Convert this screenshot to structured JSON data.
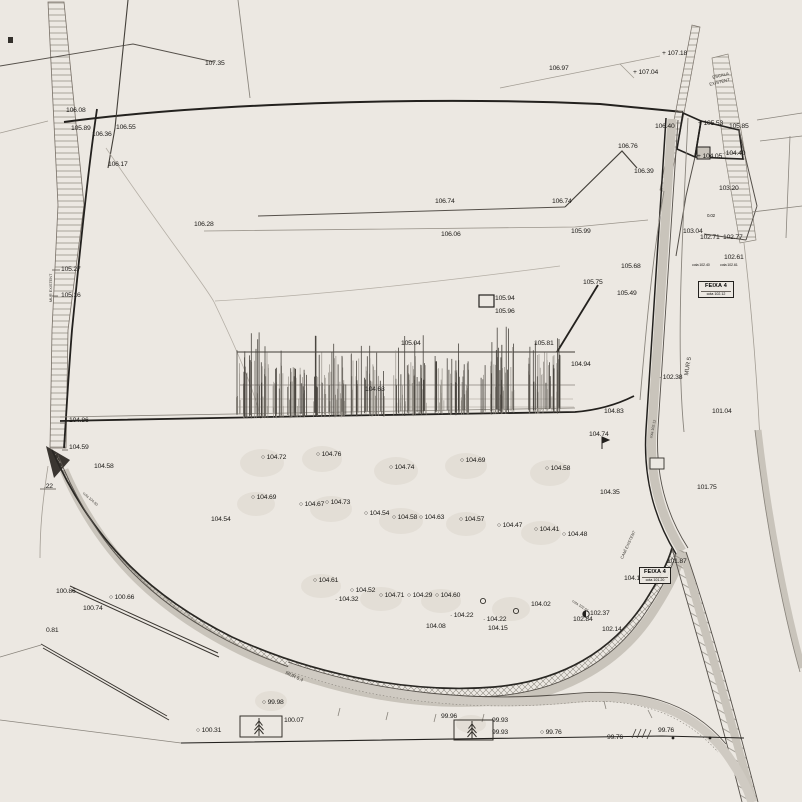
{
  "palette": {
    "background": "#ece8e2",
    "ink_dark": "#23211e",
    "ink_mid": "#55504a",
    "ink_faint": "#a39d94",
    "band_fill": "#c9c4bb",
    "hatch": "#8a857d",
    "label_text": "#1d1b18"
  },
  "plan": {
    "point_labels": [
      {
        "x": 205,
        "y": 61,
        "t": "107.35"
      },
      {
        "x": 549,
        "y": 66,
        "t": "106.97"
      },
      {
        "x": 633,
        "y": 70,
        "t": "107.04",
        "m": "+"
      },
      {
        "x": 662,
        "y": 51,
        "t": "107.18",
        "m": "+"
      },
      {
        "x": 66,
        "y": 108,
        "t": "106.08"
      },
      {
        "x": 698,
        "y": 121,
        "t": "105.53",
        "m": "+"
      },
      {
        "x": 729,
        "y": 124,
        "t": "105.85"
      },
      {
        "x": 71,
        "y": 126,
        "t": "105.89"
      },
      {
        "x": 92,
        "y": 132,
        "t": "106.36"
      },
      {
        "x": 116,
        "y": 125,
        "t": "106.55"
      },
      {
        "x": 655,
        "y": 124,
        "t": "106.40"
      },
      {
        "x": 108,
        "y": 162,
        "t": "106.17"
      },
      {
        "x": 618,
        "y": 144,
        "t": "106.76"
      },
      {
        "x": 697,
        "y": 154,
        "t": "104.05",
        "m": "+"
      },
      {
        "x": 722,
        "y": 151,
        "t": "104.40",
        "m": "d"
      },
      {
        "x": 634,
        "y": 169,
        "t": "106.39"
      },
      {
        "x": 719,
        "y": 186,
        "t": "103.20"
      },
      {
        "x": 435,
        "y": 199,
        "t": "106.74"
      },
      {
        "x": 552,
        "y": 199,
        "t": "106.74"
      },
      {
        "x": 194,
        "y": 222,
        "t": "106.28"
      },
      {
        "x": 441,
        "y": 232,
        "t": "106.06"
      },
      {
        "x": 571,
        "y": 229,
        "t": "105.99"
      },
      {
        "x": 707,
        "y": 214,
        "t": "0.02",
        "s": 4.5
      },
      {
        "x": 683,
        "y": 229,
        "t": "103.04"
      },
      {
        "x": 700,
        "y": 235,
        "t": "102.71"
      },
      {
        "x": 723,
        "y": 235,
        "t": "102.77"
      },
      {
        "x": 724,
        "y": 255,
        "t": "102.61"
      },
      {
        "x": 692,
        "y": 264,
        "t": "cota 102.40",
        "s": 3.8
      },
      {
        "x": 720,
        "y": 264,
        "t": "cota 102.61",
        "s": 3.8
      },
      {
        "x": 61,
        "y": 267,
        "t": "105.27"
      },
      {
        "x": 61,
        "y": 293,
        "t": "105.16"
      },
      {
        "x": 621,
        "y": 264,
        "t": "105.68"
      },
      {
        "x": 583,
        "y": 280,
        "t": "105.75"
      },
      {
        "x": 617,
        "y": 291,
        "t": "105.49"
      },
      {
        "x": 495,
        "y": 296,
        "t": "105.94"
      },
      {
        "x": 495,
        "y": 309,
        "t": "105.96"
      },
      {
        "x": 401,
        "y": 341,
        "t": "105.04"
      },
      {
        "x": 534,
        "y": 341,
        "t": "105.81"
      },
      {
        "x": 571,
        "y": 362,
        "t": "104.94"
      },
      {
        "x": 659,
        "y": 375,
        "t": "102.38",
        "m": "d"
      },
      {
        "x": 365,
        "y": 387,
        "t": "104.63"
      },
      {
        "x": 604,
        "y": 409,
        "t": "104.83"
      },
      {
        "x": 712,
        "y": 409,
        "t": "101.04"
      },
      {
        "x": 589,
        "y": 432,
        "t": "104.74"
      },
      {
        "x": 69,
        "y": 418,
        "t": "104.86"
      },
      {
        "x": 69,
        "y": 445,
        "t": "104.59"
      },
      {
        "x": 94,
        "y": 464,
        "t": "104.58"
      },
      {
        "x": 44,
        "y": 484,
        "t": ".22"
      },
      {
        "x": 211,
        "y": 517,
        "t": "104.54"
      },
      {
        "x": 600,
        "y": 490,
        "t": "104.35"
      },
      {
        "x": 697,
        "y": 485,
        "t": "101.75"
      },
      {
        "x": 261,
        "y": 455,
        "t": "104.72",
        "m": "c"
      },
      {
        "x": 316,
        "y": 452,
        "t": "104.76",
        "m": "c"
      },
      {
        "x": 389,
        "y": 465,
        "t": "104.74",
        "m": "c"
      },
      {
        "x": 460,
        "y": 458,
        "t": "104.69",
        "m": "c"
      },
      {
        "x": 545,
        "y": 466,
        "t": "104.58",
        "m": "c"
      },
      {
        "x": 251,
        "y": 495,
        "t": "104.69",
        "m": "c"
      },
      {
        "x": 299,
        "y": 502,
        "t": "104.67",
        "m": "c"
      },
      {
        "x": 325,
        "y": 500,
        "t": "104.73",
        "m": "c"
      },
      {
        "x": 364,
        "y": 511,
        "t": "104.54",
        "m": "c"
      },
      {
        "x": 392,
        "y": 515,
        "t": "104.58",
        "m": "c"
      },
      {
        "x": 419,
        "y": 515,
        "t": "104.63",
        "m": "c"
      },
      {
        "x": 459,
        "y": 517,
        "t": "104.57",
        "m": "c"
      },
      {
        "x": 497,
        "y": 523,
        "t": "104.47",
        "m": "c"
      },
      {
        "x": 534,
        "y": 527,
        "t": "104.41",
        "m": "c"
      },
      {
        "x": 562,
        "y": 532,
        "t": "104.48",
        "m": "c"
      },
      {
        "x": 313,
        "y": 578,
        "t": "104.61",
        "m": "c"
      },
      {
        "x": 350,
        "y": 588,
        "t": "104.52",
        "m": "c"
      },
      {
        "x": 335,
        "y": 597,
        "t": "104.32",
        "m": "d"
      },
      {
        "x": 379,
        "y": 593,
        "t": "104.71",
        "m": "c"
      },
      {
        "x": 407,
        "y": 593,
        "t": "104.29",
        "m": "c"
      },
      {
        "x": 435,
        "y": 593,
        "t": "104.60",
        "m": "c"
      },
      {
        "x": 531,
        "y": 602,
        "t": "104.02"
      },
      {
        "x": 450,
        "y": 613,
        "t": "104.22",
        "m": "d"
      },
      {
        "x": 483,
        "y": 617,
        "t": "104.22",
        "m": "d"
      },
      {
        "x": 426,
        "y": 624,
        "t": "104.08"
      },
      {
        "x": 488,
        "y": 626,
        "t": "104.15"
      },
      {
        "x": 624,
        "y": 576,
        "t": "104.13"
      },
      {
        "x": 667,
        "y": 559,
        "t": "101.87"
      },
      {
        "x": 590,
        "y": 611,
        "t": "102.37"
      },
      {
        "x": 573,
        "y": 617,
        "t": "102.84"
      },
      {
        "x": 602,
        "y": 627,
        "t": "102.14"
      },
      {
        "x": 56,
        "y": 589,
        "t": "100.86"
      },
      {
        "x": 109,
        "y": 595,
        "t": "100.66",
        "m": "c"
      },
      {
        "x": 83,
        "y": 606,
        "t": "100.74"
      },
      {
        "x": 46,
        "y": 628,
        "t": "0.81"
      },
      {
        "x": 262,
        "y": 700,
        "t": "99.98",
        "m": "c"
      },
      {
        "x": 284,
        "y": 718,
        "t": "100.07"
      },
      {
        "x": 196,
        "y": 728,
        "t": "100.31",
        "m": "c"
      },
      {
        "x": 441,
        "y": 714,
        "t": "99.96"
      },
      {
        "x": 492,
        "y": 718,
        "t": "99.93"
      },
      {
        "x": 492,
        "y": 730,
        "t": "99.93"
      },
      {
        "x": 540,
        "y": 730,
        "t": "99.76",
        "m": "c"
      },
      {
        "x": 607,
        "y": 735,
        "t": "99.76"
      },
      {
        "x": 658,
        "y": 728,
        "t": "99.76"
      }
    ],
    "rotated_texts": [
      {
        "x": 712,
        "y": 76,
        "t": "ESCALA",
        "r": -14,
        "s": 4.3
      },
      {
        "x": 709,
        "y": 83,
        "t": "EXISTENT",
        "r": -14,
        "s": 4.3
      },
      {
        "x": 684,
        "y": 375,
        "t": "MUR 5",
        "r": -80,
        "s": 6
      },
      {
        "x": 286,
        "y": 672,
        "t": "MUR 5.4",
        "r": 25,
        "s": 4.8
      },
      {
        "x": 50,
        "y": 302,
        "t": "MUR EXISTENT",
        "r": -90,
        "s": 3.8
      },
      {
        "x": 620,
        "y": 558,
        "t": "CAMÍ EXISTENT",
        "r": -65,
        "s": 4
      },
      {
        "x": 650,
        "y": 438,
        "t": "cota 102.12",
        "r": -78,
        "s": 3.6
      },
      {
        "x": 573,
        "y": 600,
        "t": "cota 102.61",
        "r": 33,
        "s": 3.6
      },
      {
        "x": 84,
        "y": 492,
        "t": "cota 104.50",
        "r": 42,
        "s": 3.6
      }
    ],
    "label_boxes": [
      {
        "x": 698,
        "y": 281,
        "w": 36,
        "h": 17,
        "title": "FEIXA 4",
        "sub": "cota 102.12"
      },
      {
        "x": 639,
        "y": 567,
        "w": 32,
        "h": 16,
        "title": "FEIXA 4",
        "sub": "cota 101.20"
      }
    ],
    "unlabeled_points": [
      {
        "x": 483,
        "y": 601
      },
      {
        "x": 516,
        "y": 611
      }
    ],
    "tree_plots": [
      {
        "x": 240,
        "y": 716,
        "w": 42,
        "h": 21,
        "tx": 259,
        "ty": 727
      },
      {
        "x": 454,
        "y": 720,
        "w": 39,
        "h": 20,
        "tx": 472,
        "ty": 730
      }
    ]
  }
}
